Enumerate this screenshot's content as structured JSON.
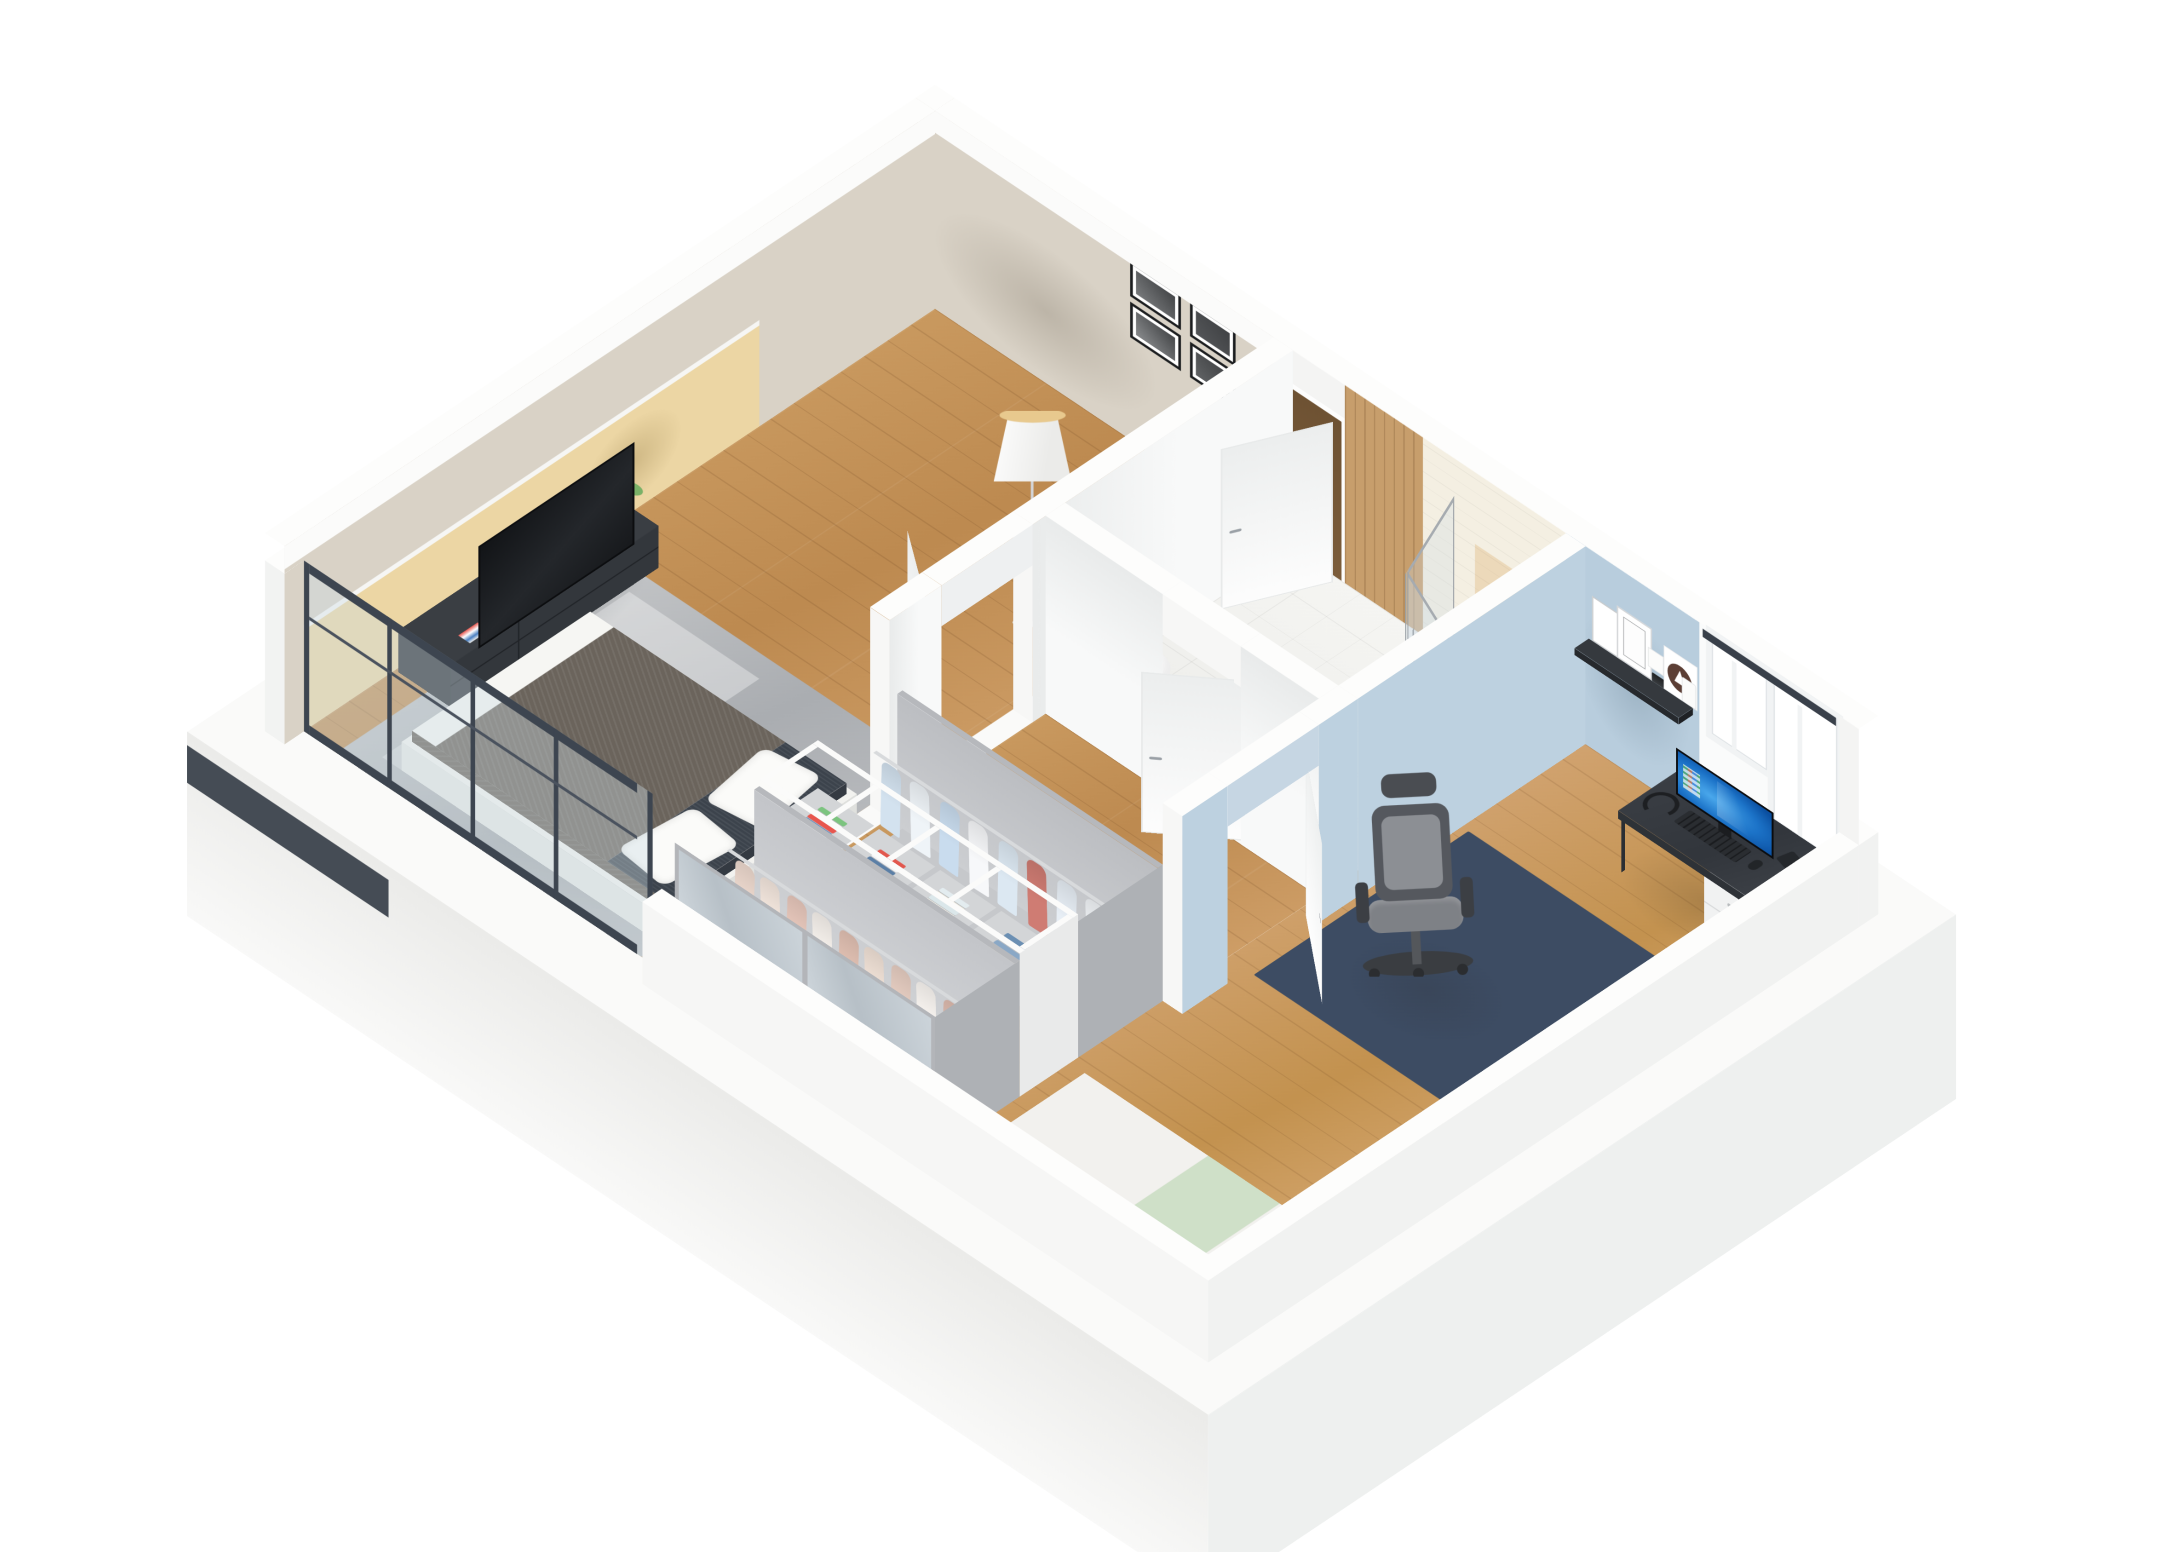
{
  "meta": {
    "title": "3D isometric cutaway floor plan render: bedroom with TV wall and glazed front, central bathroom with corner shower and toilet, hallway, double-sided open wardrobe divider, and blue-walled home office with desk setup"
  },
  "palette": {
    "background": "#ffffff",
    "exterior_white": "#f7f7f6",
    "wall_taupe": "#d9d2c6",
    "accent_yellow": "#ecd6a4",
    "accent_blue": "#b8cddd",
    "wood_floor": "#c9995f",
    "wood_floor_office": "#d2a472",
    "wood_panel": "#c79e6c",
    "tile_cream": "#f4efe2",
    "tile_beige": "#ecd9ba",
    "bath_floor": "#f5f5f2",
    "charcoal_frame": "#3d4550",
    "furniture_dark": "#35393f",
    "rug_gray": "#b7b9bd",
    "rug_navy": "#3d4c63",
    "bed_duvet": "#6b645c",
    "bed_accent_navy": "#3c434c",
    "wardrobe_gray": "#b6b8bc",
    "mirror": "#cdd3d8",
    "monitor_screen_blue": "#1c73c8",
    "logo_brown": "#5c3f35",
    "lamp_white": "#f4f4f2",
    "plant_green": "#6aa257"
  },
  "rooms": {
    "bedroom": {
      "objects": [
        "double-bed",
        "gray-duvet",
        "white-pillows-x2",
        "navy-foot-section",
        "gray-rug",
        "tv-stand",
        "flat-tv",
        "remote",
        "potted-plant",
        "floor-lamp",
        "gallery-wall-4-frames",
        "yellow-accent-wall",
        "floor-to-ceiling-glazing-dark-frames",
        "open-white-door"
      ]
    },
    "bathroom": {
      "objects": [
        "quadrant-shower-enclosure",
        "rain-shower-head",
        "chrome-riser-bar",
        "toilet",
        "wood-panel-wall",
        "cream-subway-tile",
        "beige-tile-panel",
        "white-tile-floor",
        "open-white-door"
      ]
    },
    "hallway": {
      "objects": [
        "entry-doorway",
        "open-entry-door",
        "wood-floor"
      ]
    },
    "wardrobe_divider": {
      "objects": [
        "open-hanging-unit-bedroom-side",
        "mirror-doors",
        "open-hanging-unit-office-side",
        "shelf-spine-4-cubbies",
        "folded-clothes-stacks",
        "chrome-rails"
      ]
    },
    "office": {
      "objects": [
        "blue-accent-wall",
        "black-floating-shelf",
        "leaning-posters",
        "notebook-stack",
        "white-box",
        "logo-plate",
        "white-speaker",
        "two-tall-windows",
        "dark-window-head-band",
        "desk",
        "drawer-unit",
        "monitor-windows-screen",
        "keyboard",
        "mouse",
        "mug",
        "headphones",
        "office-chair",
        "diamond-pattern-rug",
        "single-bed-white-green",
        "open-white-door"
      ]
    }
  },
  "decor": {
    "gallery_photos": [
      "#8e9092",
      "#636567",
      "#7d7f81",
      "#55575a"
    ],
    "bedroom_wardrobe_clothes": [
      "#eedacf",
      "#f5e8df",
      "#e9c9bd",
      "#f8f3ee",
      "#e3c2b4",
      "#f2e3d8",
      "#e8cfc3",
      "#fbf7f3",
      "#e0bdb0"
    ],
    "office_wardrobe_clothes": [
      "#d3e2ef",
      "#eff4f8",
      "#c9dcee",
      "#f7f8fa",
      "#dce8f2",
      "#cf7c73",
      "#e7eef5",
      "#f2f5f8"
    ],
    "cubby_stacks": [
      [
        "#7cc47f",
        "#ffffff",
        "#e8564e",
        "#4a7fc1",
        "#ffffff"
      ],
      [
        "#e2574d",
        "#f3f4f6",
        "#5b7fa6"
      ],
      [
        "#e3ecef",
        "#f2efe4",
        "#dbe7ea",
        "#f7f5ec"
      ],
      [
        "#6b8fb3",
        "#f4f4f2",
        "#8aa8c6",
        "#e8e6da"
      ]
    ]
  }
}
